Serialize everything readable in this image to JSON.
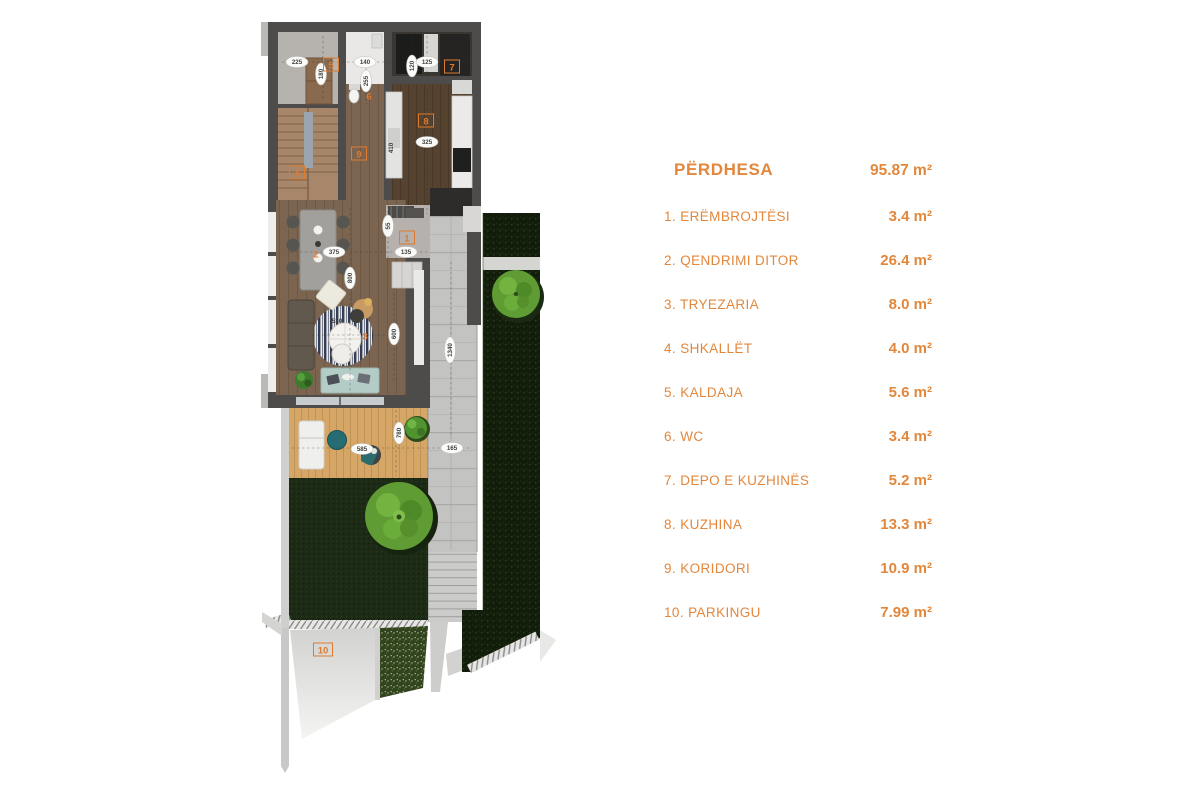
{
  "legend": {
    "title": {
      "label": "PËRDHESA",
      "value": "95.87 m²"
    },
    "rooms": [
      {
        "label": "1. ERËMBROJTËSI",
        "value": "3.4 m²"
      },
      {
        "label": "2. QENDRIMI DITOR",
        "value": "26.4 m²"
      },
      {
        "label": "3. TRYEZARIA",
        "value": "8.0 m²"
      },
      {
        "label": "4. SHKALLËT",
        "value": "4.0 m²"
      },
      {
        "label": "5. KALDAJA",
        "value": "5.6 m²"
      },
      {
        "label": "6. WC",
        "value": "3.4 m²"
      },
      {
        "label": "7. DEPO E KUZHINËS",
        "value": "5.2 m²"
      },
      {
        "label": "8. KUZHINA",
        "value": "13.3 m²"
      },
      {
        "label": "9. KORIDORI",
        "value": "10.9 m²"
      },
      {
        "label": "10. PARKINGU",
        "value": "7.99 m²"
      }
    ]
  },
  "plan": {
    "accent_color": "#E2873C",
    "label_color": "#DF7B2F",
    "room_labels": [
      {
        "num": "1",
        "x": 407,
        "y": 238,
        "boxed": true
      },
      {
        "num": "2",
        "x": 316,
        "y": 254,
        "boxed": false
      },
      {
        "num": "3",
        "x": 365,
        "y": 336,
        "boxed": false
      },
      {
        "num": "4",
        "x": 297,
        "y": 173,
        "boxed": true
      },
      {
        "num": "5",
        "x": 331,
        "y": 65,
        "boxed": true
      },
      {
        "num": "6",
        "x": 369,
        "y": 96,
        "boxed": false
      },
      {
        "num": "7",
        "x": 452,
        "y": 67,
        "boxed": true
      },
      {
        "num": "8",
        "x": 426,
        "y": 121,
        "boxed": true
      },
      {
        "num": "9",
        "x": 359,
        "y": 154,
        "boxed": true
      },
      {
        "num": "10",
        "x": 323,
        "y": 650,
        "boxed": true
      }
    ],
    "dim_labels": [
      {
        "text": "225",
        "x": 297,
        "y": 62,
        "rot": 0,
        "oval": true
      },
      {
        "text": "180",
        "x": 321,
        "y": 74,
        "rot": -90,
        "oval": true
      },
      {
        "text": "140",
        "x": 365,
        "y": 62,
        "rot": 0,
        "oval": true
      },
      {
        "text": "255",
        "x": 366,
        "y": 81,
        "rot": -90,
        "oval": true
      },
      {
        "text": "120",
        "x": 412,
        "y": 66,
        "rot": -90,
        "oval": true
      },
      {
        "text": "125",
        "x": 427,
        "y": 62,
        "rot": 0,
        "oval": true
      },
      {
        "text": "325",
        "x": 427,
        "y": 142,
        "rot": 0,
        "oval": true
      },
      {
        "text": "410",
        "x": 391,
        "y": 148,
        "rot": -90,
        "oval": false
      },
      {
        "text": "55",
        "x": 388,
        "y": 226,
        "rot": -90,
        "oval": true
      },
      {
        "text": "135",
        "x": 406,
        "y": 252,
        "rot": 0,
        "oval": true
      },
      {
        "text": "375",
        "x": 334,
        "y": 252,
        "rot": 0,
        "oval": true
      },
      {
        "text": "800",
        "x": 350,
        "y": 278,
        "rot": -90,
        "oval": true
      },
      {
        "text": "530",
        "x": 337,
        "y": 321,
        "rot": 0,
        "oval": false
      },
      {
        "text": "600",
        "x": 394,
        "y": 334,
        "rot": -90,
        "oval": true
      },
      {
        "text": "1340",
        "x": 450,
        "y": 350,
        "rot": -90,
        "oval": true
      },
      {
        "text": "585",
        "x": 362,
        "y": 449,
        "rot": 0,
        "oval": true
      },
      {
        "text": "780",
        "x": 399,
        "y": 433,
        "rot": -90,
        "oval": true
      },
      {
        "text": "165",
        "x": 452,
        "y": 448,
        "rot": 0,
        "oval": true
      }
    ]
  }
}
